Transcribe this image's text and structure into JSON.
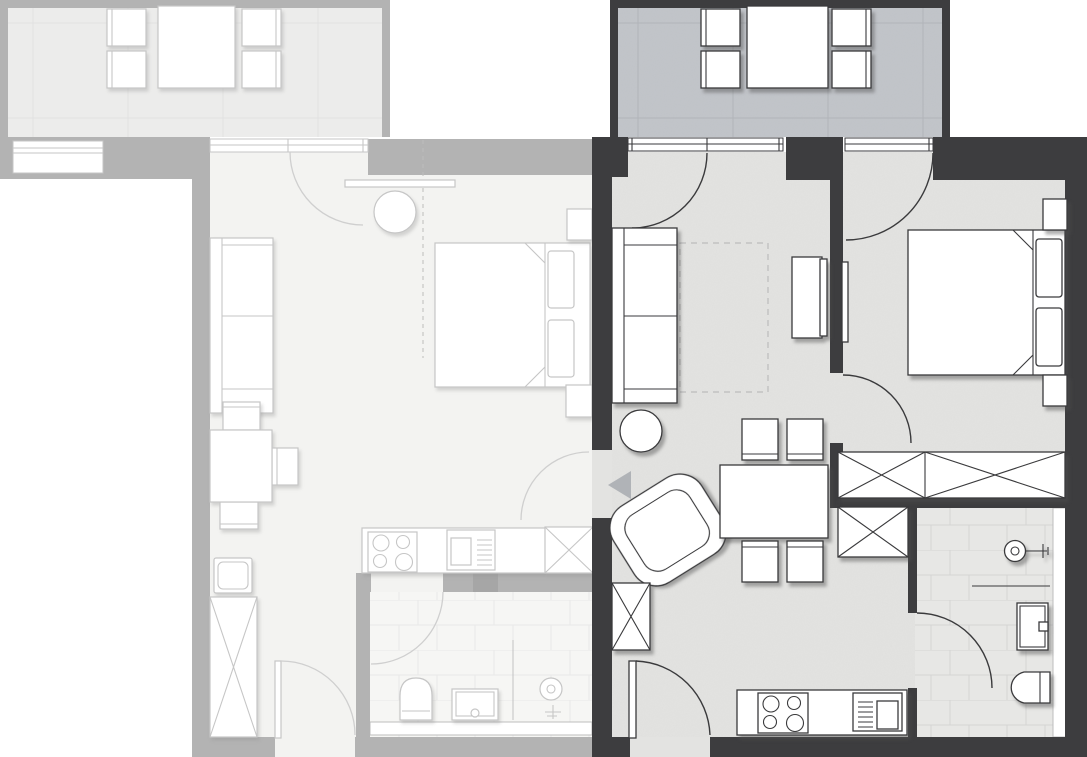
{
  "title": "Two-unit apartment floor plan with highlighted (selected) unit",
  "colors": {
    "wall_active": "#3d3d3f",
    "wall_inactive": "#b3b3b3",
    "wall_inactive_dark": "#a6a6a6",
    "floor_active": "#e3e3e1",
    "floor_inactive": "#f3f3f1",
    "balcony_floor_active": "#c2c5ca",
    "balcony_floor_inactive": "#ececeb",
    "line_active": "#3a3a3c",
    "line_inactive": "#c6c6c6",
    "line_inactive_soft": "#cfcfcf",
    "tile_line_active": "#d4d4d4",
    "tile_line_inactive": "#e8e8e8",
    "grid_active": "#b2b5ba",
    "grid_inactive": "#e2e2e1",
    "rug_dash": "#bcbcbc",
    "entrance_arrow": "#b0b3b7",
    "furniture_fill": "#ffffff",
    "background": "#ffffff"
  },
  "apartments": {
    "right": {
      "id": "unit-right",
      "state": "active-selected",
      "wall_style": "dark",
      "rooms": [
        "balcony",
        "living-room",
        "bedroom",
        "hall",
        "bathroom",
        "kitchen"
      ],
      "furniture": {
        "balcony": [
          "outdoor-table",
          "outdoor-chair x4"
        ],
        "living_room": [
          "sofa",
          "round-side-table",
          "armchair",
          "rug-dashed",
          "tv-sideboard",
          "dining-table",
          "dining-chair x4"
        ],
        "bedroom": [
          "double-bed",
          "pillow x2",
          "nightstand x2",
          "wall-radiator"
        ],
        "hall": [
          "wardrobe-long-2-sections",
          "wardrobe-small",
          "entry-cabinet",
          "entrance-arrow"
        ],
        "bathroom": [
          "shower-fitting",
          "shower-screen",
          "washbasin",
          "toilet"
        ],
        "kitchen": [
          "counter",
          "cooktop-4-burners",
          "sink-with-drainer"
        ]
      },
      "doors": [
        "balcony-door-living",
        "balcony-door-bedroom",
        "bedroom-door",
        "bathroom-door",
        "apartment-entry-door-bottom",
        "side-opening-with-arrow"
      ]
    },
    "left": {
      "id": "unit-left",
      "state": "inactive-grayed",
      "wall_style": "light-gray",
      "rooms": [
        "balcony",
        "studio-living-sleeping-area",
        "kitchen",
        "bathroom"
      ],
      "furniture": {
        "balcony": [
          "outdoor-table",
          "outdoor-chair x4"
        ],
        "studio": [
          "sofa",
          "round-table",
          "wall-shelf",
          "double-bed",
          "pillow x2",
          "nightstand x2",
          "dining-table",
          "dining-chair x3",
          "single-chair",
          "tall-wardrobe",
          "optional-partition-dashed"
        ],
        "kitchen": [
          "counter",
          "cooktop-4-burners",
          "sink-with-drainer",
          "cabinet-x-box"
        ],
        "bathroom": [
          "toilet",
          "washbasin",
          "shower-fitting",
          "threshold-strip"
        ]
      },
      "doors": [
        "balcony-door",
        "bathroom-door",
        "apartment-entry-door-bottom",
        "side-entry-door"
      ]
    }
  },
  "entrance_marker": {
    "shape": "triangle",
    "direction": "left",
    "meaning": "unit entrance"
  }
}
